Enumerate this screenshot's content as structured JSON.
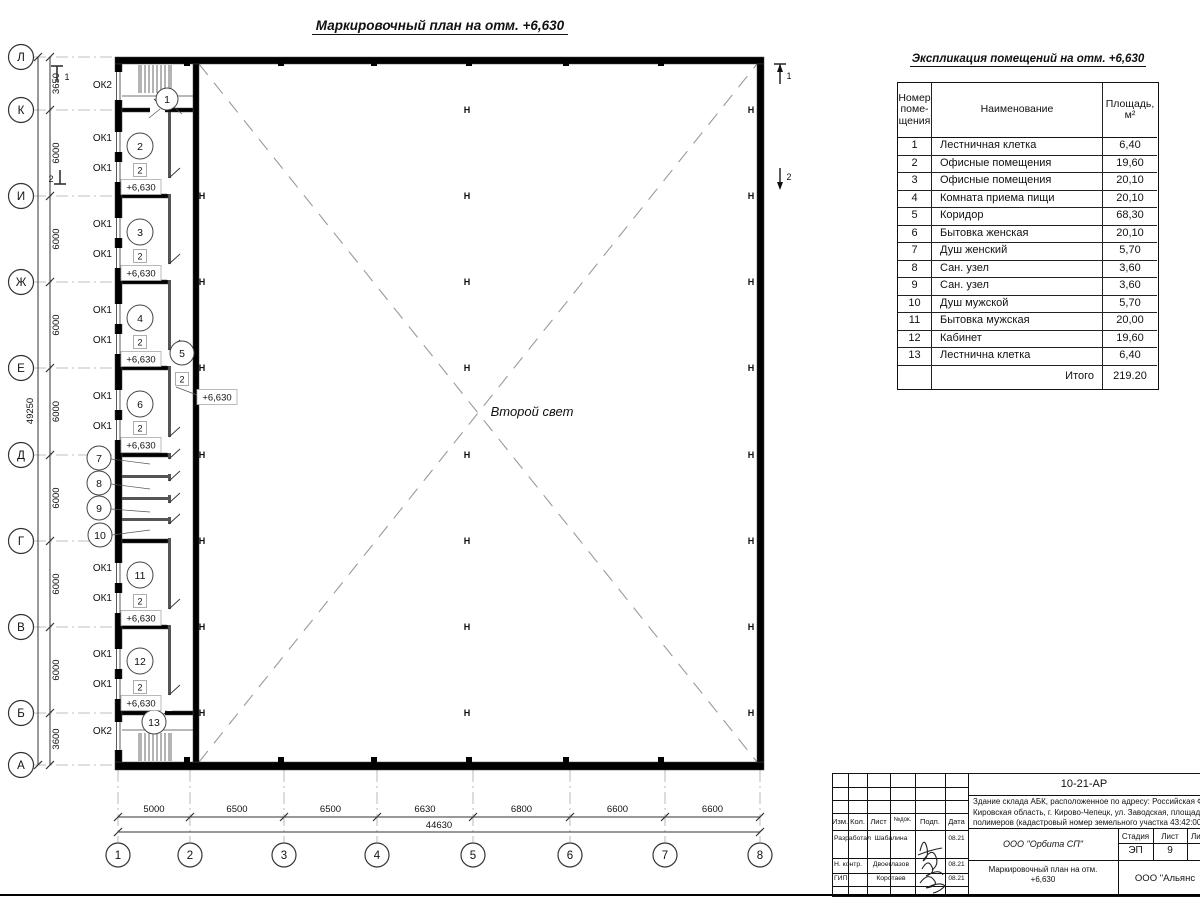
{
  "plan": {
    "title": "Маркировочный план на отм. +6,630",
    "second_light": "Второй свет",
    "elevation": "+6,630",
    "type_tag": "2",
    "axes_left": [
      {
        "label": "Л",
        "y": 57
      },
      {
        "label": "К",
        "y": 110
      },
      {
        "label": "И",
        "y": 196
      },
      {
        "label": "Ж",
        "y": 282
      },
      {
        "label": "Е",
        "y": 368
      },
      {
        "label": "Д",
        "y": 455
      },
      {
        "label": "Г",
        "y": 541
      },
      {
        "label": "В",
        "y": 627
      },
      {
        "label": "Б",
        "y": 713
      },
      {
        "label": "А",
        "y": 765
      }
    ],
    "axes_bottom": [
      {
        "label": "1",
        "x": 118
      },
      {
        "label": "2",
        "x": 190
      },
      {
        "label": "3",
        "x": 284
      },
      {
        "label": "4",
        "x": 377
      },
      {
        "label": "5",
        "x": 473
      },
      {
        "label": "6",
        "x": 570
      },
      {
        "label": "7",
        "x": 665
      },
      {
        "label": "8",
        "x": 760
      }
    ],
    "dims_left": {
      "segments": [
        "3650",
        "6000",
        "6000",
        "6000",
        "6000",
        "6000",
        "6000",
        "6000",
        "3600"
      ],
      "overall": "49250"
    },
    "dims_bottom": {
      "segments": [
        "5000",
        "6500",
        "6500",
        "6630",
        "6800",
        "6600",
        "6600"
      ],
      "overall": "44630"
    },
    "window_labels": [
      {
        "text": "ОК2",
        "x": 112,
        "y": 88
      },
      {
        "text": "ОК1",
        "x": 112,
        "y": 141
      },
      {
        "text": "ОК1",
        "x": 112,
        "y": 171
      },
      {
        "text": "ОК1",
        "x": 112,
        "y": 227
      },
      {
        "text": "ОК1",
        "x": 112,
        "y": 257
      },
      {
        "text": "ОК1",
        "x": 112,
        "y": 313
      },
      {
        "text": "ОК1",
        "x": 112,
        "y": 343
      },
      {
        "text": "ОК1",
        "x": 112,
        "y": 399
      },
      {
        "text": "ОК1",
        "x": 112,
        "y": 429
      },
      {
        "text": "ОК1",
        "x": 112,
        "y": 571
      },
      {
        "text": "ОК1",
        "x": 112,
        "y": 601
      },
      {
        "text": "ОК1",
        "x": 112,
        "y": 657
      },
      {
        "text": "ОК1",
        "x": 112,
        "y": 687
      },
      {
        "text": "ОК2",
        "x": 112,
        "y": 734
      }
    ],
    "rooms": [
      {
        "n": "1",
        "x": 167,
        "y": 99,
        "r": 11
      },
      {
        "n": "2",
        "x": 140,
        "y": 146,
        "r": 13
      },
      {
        "n": "3",
        "x": 140,
        "y": 232,
        "r": 13
      },
      {
        "n": "4",
        "x": 140,
        "y": 318,
        "r": 13
      },
      {
        "n": "5",
        "x": 182,
        "y": 353,
        "r": 12
      },
      {
        "n": "6",
        "x": 140,
        "y": 404,
        "r": 13
      },
      {
        "n": "7",
        "x": 99,
        "y": 458,
        "r": 12
      },
      {
        "n": "8",
        "x": 99,
        "y": 483,
        "r": 12
      },
      {
        "n": "9",
        "x": 99,
        "y": 508,
        "r": 12
      },
      {
        "n": "10",
        "x": 100,
        "y": 535,
        "r": 12
      },
      {
        "n": "11",
        "x": 140,
        "y": 575,
        "r": 13
      },
      {
        "n": "12",
        "x": 140,
        "y": 661,
        "r": 13
      },
      {
        "n": "13",
        "x": 154,
        "y": 722,
        "r": 12
      }
    ],
    "type_tags": [
      {
        "x": 140,
        "y": 170
      },
      {
        "x": 140,
        "y": 256
      },
      {
        "x": 140,
        "y": 342
      },
      {
        "x": 182,
        "y": 379
      },
      {
        "x": 140,
        "y": 428
      },
      {
        "x": 140,
        "y": 601
      },
      {
        "x": 140,
        "y": 687
      }
    ],
    "elev_tags": [
      {
        "x": 141,
        "y": 187
      },
      {
        "x": 141,
        "y": 273
      },
      {
        "x": 141,
        "y": 359
      },
      {
        "x": 141,
        "y": 445
      },
      {
        "x": 141,
        "y": 618
      },
      {
        "x": 141,
        "y": 703
      },
      {
        "x": 217,
        "y": 397
      }
    ],
    "section_marks": {
      "s1": "1",
      "s2": "2"
    }
  },
  "table": {
    "title": "Экспликация помещений на отм. +6,630",
    "headers": [
      [
        "Номер",
        "поме-",
        "щения"
      ],
      [
        "Наименование"
      ],
      [
        "Площадь,",
        "м²"
      ]
    ],
    "rows": [
      {
        "num": "1",
        "name": "Лестничная клетка",
        "area": "6,40"
      },
      {
        "num": "2",
        "name": "Офисные помещения",
        "area": "19,60"
      },
      {
        "num": "3",
        "name": "Офисные помещения",
        "area": "20,10"
      },
      {
        "num": "4",
        "name": "Комната приема пищи",
        "area": "20,10"
      },
      {
        "num": "5",
        "name": "Коридор",
        "area": "68,30"
      },
      {
        "num": "6",
        "name": "Бытовка женская",
        "area": "20,10"
      },
      {
        "num": "7",
        "name": "Душ женский",
        "area": "5,70"
      },
      {
        "num": "8",
        "name": "Сан. узел",
        "area": "3,60"
      },
      {
        "num": "9",
        "name": "Сан. узел",
        "area": "3,60"
      },
      {
        "num": "10",
        "name": "Душ мужской",
        "area": "5,70"
      },
      {
        "num": "11",
        "name": "Бытовка мужская",
        "area": "20,00"
      },
      {
        "num": "12",
        "name": "Кабинет",
        "area": "19,60"
      },
      {
        "num": "13",
        "name": "Лестнична клетка",
        "area": "6,40"
      }
    ],
    "total_label": "Итого",
    "total_value": "219.20"
  },
  "titleblock": {
    "doc_code": "10-21-АР",
    "address_lines": [
      "Здание склада АБК, расположенное по адресу: Российская Феде",
      "Кировская область, г. Кирово-Чепецк, ул. Заводская, площадка з",
      "полимеров (кадастровый номер земельного участка 43:42:0000"
    ],
    "columns": [
      "Изм.",
      "Кол.",
      "Лист",
      "№док.",
      "Подп.",
      "Дата"
    ],
    "sign_rows": [
      {
        "role": "Разработал",
        "name": "Шабалина",
        "date": "08.21"
      },
      {
        "role": "Н. контр.",
        "name": "Двоеглазов",
        "date": "08.21"
      },
      {
        "role": "ГИП",
        "name": "Коротаев",
        "date": "08.21"
      }
    ],
    "org": "ООО \"Орбита СП\"",
    "stage_headers": [
      "Стадия",
      "Лист",
      "Листов"
    ],
    "stage_values": [
      "ЭП",
      "9",
      "1"
    ],
    "doc_title_lines": [
      "Маркировочный план на отм.",
      "+6,630"
    ],
    "org2": "ООО \"Альянс"
  }
}
